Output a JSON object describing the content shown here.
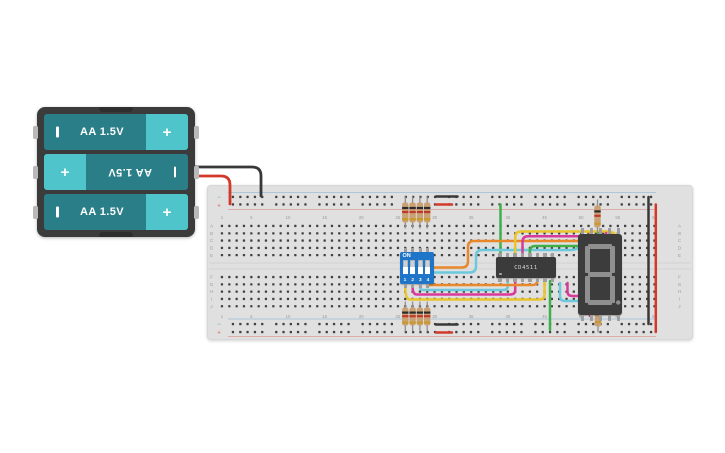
{
  "app": {
    "background": "#ffffff",
    "view": "circuit-design-canvas"
  },
  "colors": {
    "board": "#e0e0e0",
    "hole": "#404040",
    "board_label": "#999999",
    "rail_blue": "#84b2d2",
    "rail_red": "#d9837a",
    "battery_frame": "#3b3b3b",
    "battery_cell": "#2a7e87",
    "battery_terminal": "#4fc4ca",
    "dip_blue": "#1f75c8",
    "ic_body": "#3b3b3b",
    "display_body": "#3c3c3c",
    "segment": "#8f8f8f",
    "pin_metal": "#9e9e9e",
    "resistor_body": "#c9a172",
    "lead": "#8f8f8f",
    "band_black": "#2b2b2b",
    "band_red": "#c03a2b",
    "band_gold": "#c7992e",
    "wire_red": "#d4382b",
    "wire_black": "#383838",
    "wire_yellow": "#e9c42c",
    "wire_magenta": "#d83a9c",
    "wire_cyan": "#6cc8dc",
    "wire_orange": "#e8882a",
    "wire_green": "#3faf4c"
  },
  "battery": {
    "type": "3x AA battery pack",
    "plus_symbol": "+",
    "cells": [
      {
        "label": "AA 1.5V",
        "orientation": "normal"
      },
      {
        "label": "AA 1.5V",
        "orientation": "flipped"
      },
      {
        "label": "AA 1.5V",
        "orientation": "normal"
      }
    ]
  },
  "breadboard": {
    "row_letters_top": [
      "A",
      "B",
      "C",
      "D",
      "E"
    ],
    "row_letters_bottom": [
      "F",
      "G",
      "H",
      "I",
      "J"
    ],
    "column_numbers": [
      1,
      5,
      10,
      15,
      20,
      25,
      30,
      35,
      40,
      45,
      50,
      55,
      60
    ],
    "rail_minus_symbol": "−",
    "rail_plus_symbol": "+"
  },
  "dip_switch": {
    "label": "ON",
    "positions": [
      "1",
      "2",
      "3",
      "4"
    ],
    "state": [
      "off",
      "off",
      "off",
      "off"
    ]
  },
  "ic": {
    "label": "CD4511",
    "pins": 16
  },
  "seven_segment_display": {
    "digit_shown": "8",
    "decimal_point": true,
    "state": "off (all segments gray)"
  },
  "resistors": {
    "count": 10,
    "band_colors": [
      "black",
      "red",
      "gold"
    ],
    "groups": [
      "4 pull resistors above DIP switch",
      "4 pull resistors below DIP switch",
      "1 resistor above display",
      "1 resistor below display"
    ]
  },
  "wires": [
    {
      "name": "battery-negative-to-rail",
      "color": "black"
    },
    {
      "name": "battery-positive-to-rail",
      "color": "red"
    },
    {
      "name": "top-rail-bridge-black",
      "color": "black"
    },
    {
      "name": "top-rail-bridge-red",
      "color": "red"
    },
    {
      "name": "bottom-rail-bridge-black",
      "color": "black"
    },
    {
      "name": "bottom-rail-bridge-red",
      "color": "red"
    },
    {
      "name": "right-rail-link-black",
      "color": "black"
    },
    {
      "name": "right-rail-link-red",
      "color": "red"
    },
    {
      "name": "power-to-ic-green",
      "color": "green"
    },
    {
      "name": "ic-to-ground-green",
      "color": "green"
    },
    {
      "name": "dip-to-ic-yellow",
      "color": "yellow"
    },
    {
      "name": "dip-to-ic-magenta",
      "color": "magenta"
    },
    {
      "name": "dip-to-ic-cyan",
      "color": "cyan"
    },
    {
      "name": "dip-to-ic-orange",
      "color": "orange"
    },
    {
      "name": "dip-to-display-orange",
      "color": "orange"
    },
    {
      "name": "dip-to-display-cyan",
      "color": "cyan"
    },
    {
      "name": "ic-to-display-yellow",
      "color": "yellow"
    },
    {
      "name": "ic-to-display-magenta",
      "color": "magenta"
    },
    {
      "name": "ic-to-display-green",
      "color": "green"
    },
    {
      "name": "display-return-cyan",
      "color": "cyan"
    },
    {
      "name": "display-return-magenta",
      "color": "magenta"
    }
  ]
}
